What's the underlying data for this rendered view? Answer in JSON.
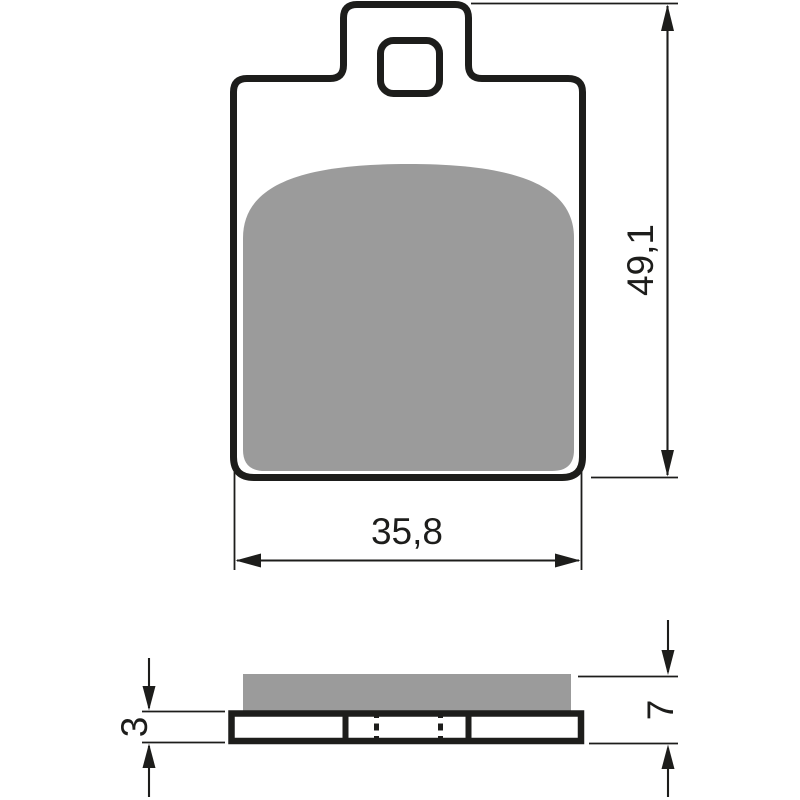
{
  "colors": {
    "line": "#1d1d1b",
    "pad": "#9b9b9b",
    "background": "#ffffff"
  },
  "front_view": {
    "height_label": "49,1",
    "width_label": "35,8"
  },
  "side_view": {
    "backplate_label": "3",
    "overall_label": "7"
  }
}
